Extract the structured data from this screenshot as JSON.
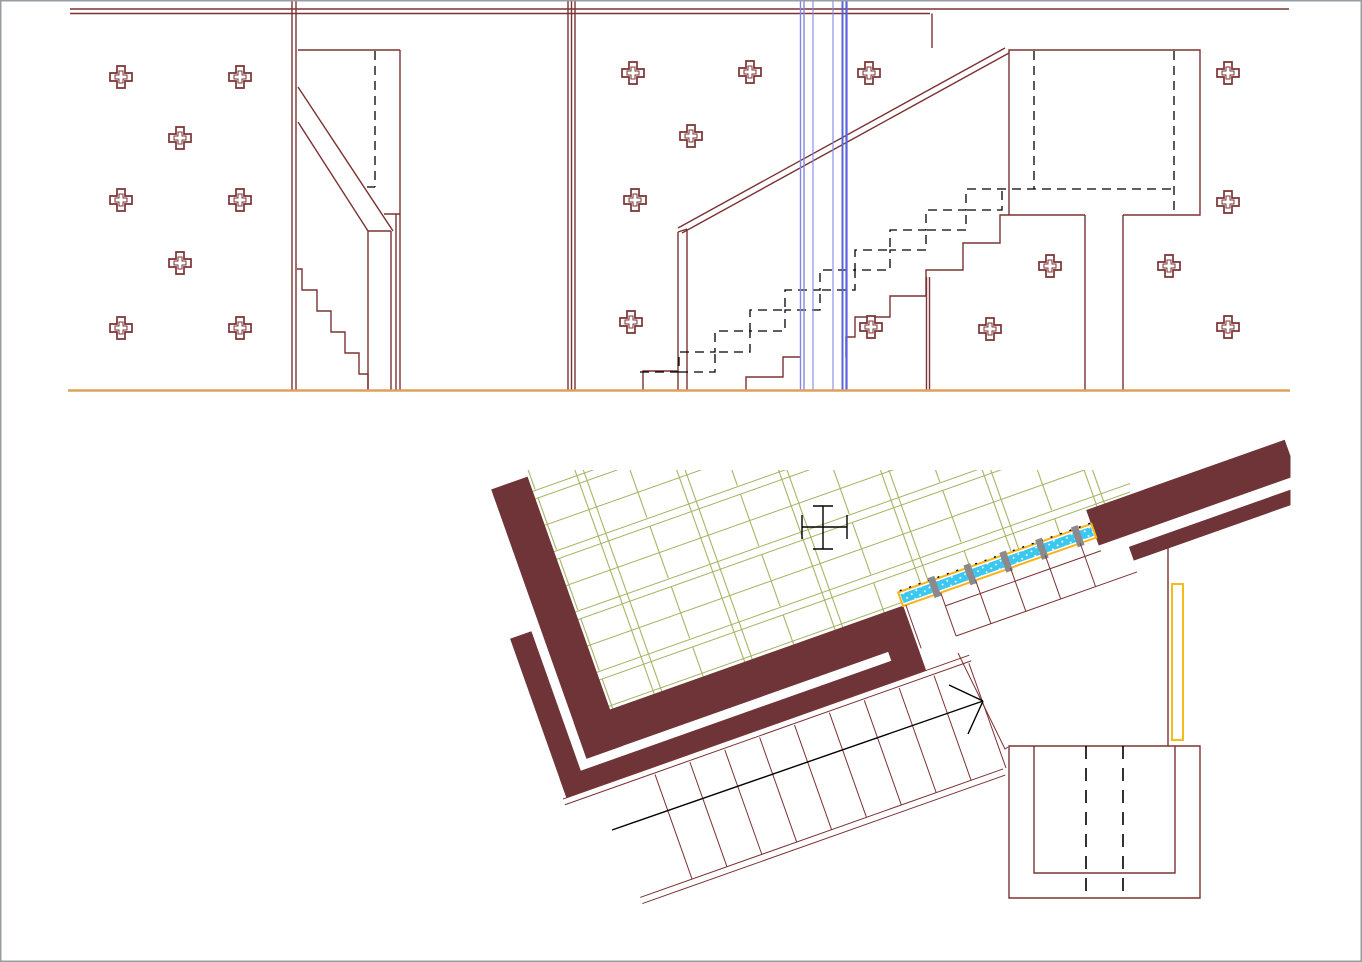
{
  "meta": {
    "kind": "cad-architectural-drawing",
    "subject": "staircase elevations and rotated stair plan",
    "canvas": {
      "width": 1362,
      "height": 962
    }
  },
  "palette": {
    "background": "#ffffff",
    "frame_gray": "#989ca3",
    "maroon_line": "#7b3233",
    "maroon_fill": "#6f3437",
    "black": "#000000",
    "ground_orange": "#dea15c",
    "blue_light": "#8289e2",
    "blue_dark": "#5a64d8",
    "green_tile": "#a4b363",
    "cyan_rail": "#3bc8f0",
    "rail_border": "#fcb315",
    "post_gray": "#8a8a8e",
    "door_yellow": "#f2bc1b"
  },
  "elevation": {
    "ground_line": {
      "y": 390.5,
      "x1": 68,
      "x2": 1290
    },
    "wall_anchor_crosses": [
      [
        121,
        77
      ],
      [
        240,
        77
      ],
      [
        180,
        138
      ],
      [
        121,
        200
      ],
      [
        240,
        200
      ],
      [
        180,
        263
      ],
      [
        121,
        328
      ],
      [
        240,
        328
      ],
      [
        633,
        73
      ],
      [
        750,
        72
      ],
      [
        691,
        136
      ],
      [
        635,
        200
      ],
      [
        631,
        322
      ],
      [
        869,
        73
      ],
      [
        1228,
        73
      ],
      [
        1228,
        202
      ],
      [
        1050,
        266
      ],
      [
        1169,
        266
      ],
      [
        871,
        327
      ],
      [
        990,
        329
      ],
      [
        1228,
        327
      ]
    ],
    "glazing_lines": [
      {
        "x": 800.5,
        "w": 1.4,
        "tone": "light"
      },
      {
        "x": 804.0,
        "w": 1.4,
        "tone": "light"
      },
      {
        "x": 813.0,
        "w": 1.1,
        "tone": "light"
      },
      {
        "x": 833.0,
        "w": 1.1,
        "tone": "light"
      },
      {
        "x": 842.5,
        "w": 2.0,
        "tone": "dark"
      },
      {
        "x": 846.5,
        "w": 2.2,
        "tone": "dark"
      }
    ]
  },
  "plan": {
    "rotation_deg": -19.5,
    "origin": [
      903,
      606
    ],
    "guard_rail_strip": {
      "length": 205,
      "posts_u": [
        36,
        74,
        112,
        150,
        188
      ]
    },
    "upper_flight_treads_u": [
      3,
      40,
      77,
      114,
      151,
      188
    ],
    "lower_flight_treads_u": [
      -290,
      -253,
      -216,
      -179,
      -142,
      -105,
      -68,
      -31,
      6,
      43
    ],
    "direction_arrow": {
      "from": [
        612,
        830
      ],
      "tip": [
        983,
        701
      ],
      "barb1": [
        949,
        685
      ],
      "barb2": [
        968,
        734
      ]
    }
  }
}
